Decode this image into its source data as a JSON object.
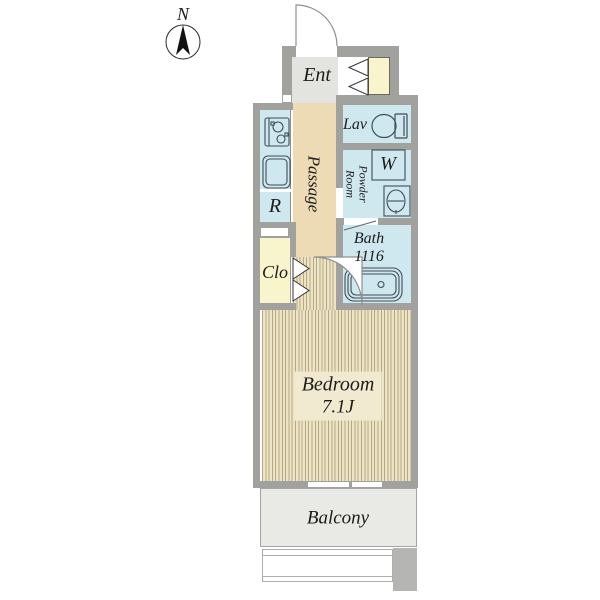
{
  "compass": {
    "north_label": "N"
  },
  "rooms": {
    "entrance": {
      "label": "Ent"
    },
    "lavatory": {
      "label": "Lav"
    },
    "passage": {
      "label": "Passage"
    },
    "powder_room": {
      "line1": "Powder",
      "line2": "Room"
    },
    "washing_machine": {
      "label": "W"
    },
    "refrigerator_space": {
      "label": "R"
    },
    "bath": {
      "label": "Bath",
      "size": "1116"
    },
    "closet": {
      "label": "Clo"
    },
    "bedroom": {
      "label": "Bedroom",
      "size": "7.1J"
    },
    "balcony": {
      "label": "Balcony"
    }
  },
  "colors": {
    "wall": "#a1a19e",
    "wet_room_blue": "#cfe7ef",
    "passage_beige": "#ecdbb4",
    "entrance_floor": "#e3e3e0",
    "cabinet_yellow": "#f8f4cb",
    "flooring_base": "#ede4c6",
    "flooring_stripe": "#b7a884",
    "balcony_gray": "#e9e9e6",
    "pillar_gray": "#b5b5b3",
    "fixture_stroke": "#3f4e57"
  }
}
